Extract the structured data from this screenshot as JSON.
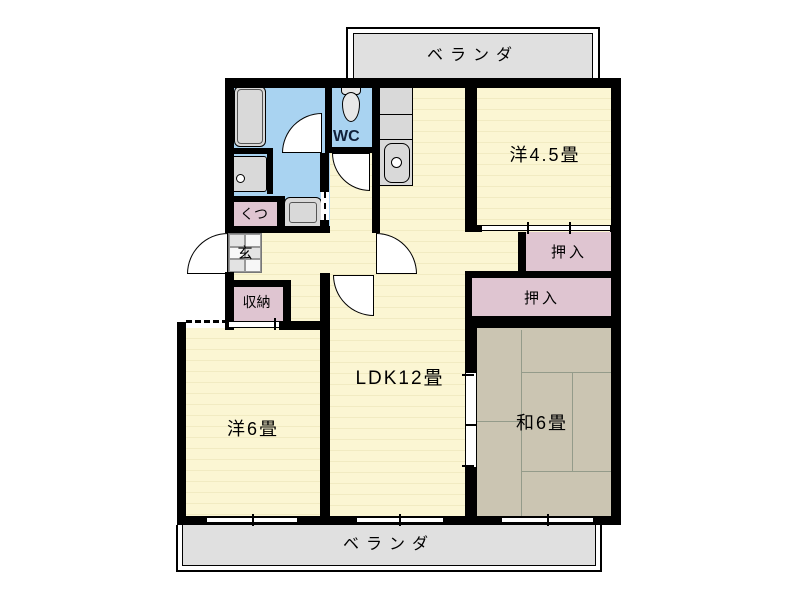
{
  "plan_title": "3LDK apartment floor plan",
  "verandas": {
    "top_label": "ベランダ",
    "bottom_label": "ベランダ"
  },
  "rooms": {
    "ldk": {
      "label": "LDK12畳"
    },
    "western6": {
      "label": "洋6畳"
    },
    "western45": {
      "label": "洋4.5畳"
    },
    "japanese6": {
      "label": "和6畳"
    },
    "wc": {
      "label": "WC"
    },
    "genkan": {
      "label": "玄"
    },
    "shoes": {
      "label": "くつ"
    },
    "storage": {
      "label": "収納"
    },
    "closet_upper": {
      "label": "押入"
    },
    "closet_lower": {
      "label": "押入"
    }
  },
  "colors": {
    "wall": "#000000",
    "floor_yellow": "#FBF6D3",
    "floor_stripe": "#F1EBC2",
    "wet_blue": "#A9D3F1",
    "closet_pink": "#DFC5D1",
    "tatami": "#CBC5B2",
    "tatami_line": "#949B8A",
    "veranda_gray": "#E0E0E0",
    "fixture_gray": "#D9D9D9"
  }
}
